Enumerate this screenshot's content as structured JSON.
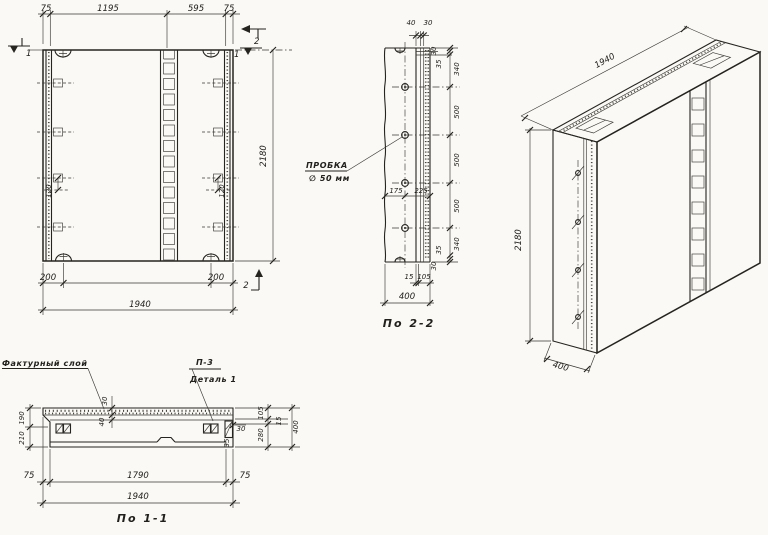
{
  "front_view": {
    "dims_top": [
      "75",
      "1195",
      "595",
      "75"
    ],
    "dim_height": "2180",
    "dim_bottom_left": "200",
    "dim_bottom_right": "200",
    "dim_width": "1940",
    "dim_anchor_left": "120",
    "dim_anchor_right": "120",
    "mark_cut1_left": "1",
    "mark_cut2_top": "2",
    "mark_cut1_top": "1",
    "mark_cut2_bottom": "2"
  },
  "section_2": {
    "title": "По 2-2",
    "dim_top_40": "40",
    "dim_top_30": "30",
    "dims_right": [
      "30",
      "35",
      "340",
      "500",
      "500",
      "500",
      "340",
      "35",
      "30"
    ],
    "dim_plug_left": "175",
    "dim_plug_right": "225",
    "dim_bottom_15": "15",
    "dim_bottom_105": "105",
    "dim_thickness": "400",
    "plug_note_line1": "ПРОБКА",
    "plug_note_line2": "∅ 50 мм"
  },
  "isometric": {
    "dim_length": "1940",
    "dim_height": "2180",
    "dim_thickness": "400"
  },
  "section_1": {
    "title": "По 1-1",
    "note_facing": "Фактурный слой",
    "note_detail_ref": "П-3",
    "note_detail_name": "Деталь 1",
    "dim_left_top": "190",
    "dim_left_bottom": "210",
    "dim_mid_30": "30",
    "dim_mid_40": "40",
    "dims_right": [
      "105",
      "15",
      "280",
      "400"
    ],
    "dim_end_30": "30",
    "dim_end_35": "35",
    "dim_bottom_left": "75",
    "dim_bottom_mid": "1790",
    "dim_bottom_right": "75",
    "dim_width": "1940"
  }
}
